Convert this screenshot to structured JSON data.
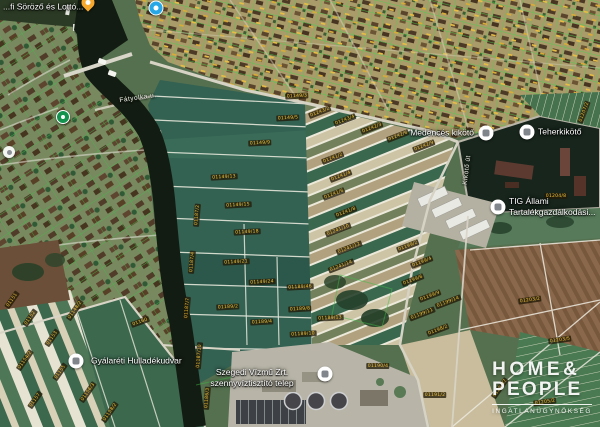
{
  "app": {
    "type": "satellite-map-with-cadastral-overlay",
    "region": "Szeged / Gyálarét, Tisza riverside"
  },
  "watermark": {
    "line1": "HOME&",
    "line2": "PEOPLE",
    "tagline": "INGATLANÜGYNÖKSÉG"
  },
  "colors": {
    "cadastral_green": "#43bd4b",
    "parcel_label_text": "#f0c23c",
    "field_green": "#336152",
    "river_water": "#131c12",
    "harbor_water": "#17251c",
    "poi_white": "#ffffff",
    "pin_orange": "#f7a92d",
    "marker_blue": "#28a7e6",
    "marker_green": "#13934e"
  },
  "pois": [
    {
      "id": "sorozo-lotto",
      "kind": "pin-orange",
      "x": 88,
      "y": 7,
      "label": "...fi Söröző és Lottó...",
      "label_x": 3,
      "label_y": 7,
      "align": "left"
    },
    {
      "id": "blue-place",
      "kind": "circle-blue",
      "x": 156,
      "y": 8
    },
    {
      "id": "park-place",
      "kind": "circle-green",
      "x": 63,
      "y": 117
    },
    {
      "id": "small-white-place",
      "kind": "circle-white-small",
      "x": 9,
      "y": 152
    },
    {
      "id": "gyalareti-hulladekudvar",
      "kind": "circle-white",
      "x": 76,
      "y": 361,
      "label": "Gyálaréti Hulladékudvar",
      "label_x": 91,
      "label_y": 361,
      "align": "left"
    },
    {
      "id": "szegedi-vizmu",
      "kind": "circle-white",
      "x": 325,
      "y": 374,
      "lines": [
        "Szegedi Vízmű Zrt.",
        "szennyvíztisztító telep"
      ],
      "label_x": 252,
      "label_y": 378,
      "align": "center"
    },
    {
      "id": "tig-allami",
      "kind": "circle-white",
      "x": 498,
      "y": 207,
      "lines": [
        "TIG Állami",
        "Tartalékgazdálkodási..."
      ],
      "label_x": 509,
      "label_y": 207,
      "align": "left"
    },
    {
      "id": "medences-kikoto",
      "kind": "circle-white",
      "x": 486,
      "y": 133,
      "label": "Medencés kikötő",
      "label_x": 474,
      "label_y": 133,
      "align": "right"
    },
    {
      "id": "teherkikoto",
      "kind": "circle-white",
      "x": 527,
      "y": 132,
      "label": "Teherkikötő",
      "label_x": 538,
      "label_y": 132,
      "align": "left"
    }
  ],
  "street_labels": [
    {
      "text": "Fátyolka u.",
      "x": 138,
      "y": 98,
      "rot": -8
    },
    {
      "text": "Kikötő út",
      "x": 467,
      "y": 170,
      "rot": -83
    }
  ],
  "parcel_labels": [
    {
      "t": "01149/3",
      "x": 297,
      "y": 96,
      "r": -3
    },
    {
      "t": "01149/5",
      "x": 288,
      "y": 118,
      "r": -3
    },
    {
      "t": "01149/9",
      "x": 260,
      "y": 143,
      "r": -3
    },
    {
      "t": "01149/13",
      "x": 224,
      "y": 177,
      "r": -3
    },
    {
      "t": "01149/15",
      "x": 238,
      "y": 205,
      "r": -3
    },
    {
      "t": "01149/18",
      "x": 247,
      "y": 232,
      "r": -3
    },
    {
      "t": "01149/21",
      "x": 236,
      "y": 262,
      "r": -3
    },
    {
      "t": "01149/24",
      "x": 262,
      "y": 282,
      "r": -3
    },
    {
      "t": "01189/2",
      "x": 228,
      "y": 307,
      "r": -3
    },
    {
      "t": "01189/4",
      "x": 262,
      "y": 322,
      "r": -3
    },
    {
      "t": "01189/8",
      "x": 300,
      "y": 309,
      "r": -3
    },
    {
      "t": "01189/10",
      "x": 303,
      "y": 334,
      "r": -3
    },
    {
      "t": "01189/13",
      "x": 330,
      "y": 318,
      "r": -3
    },
    {
      "t": "01189/46",
      "x": 300,
      "y": 287,
      "r": -3
    },
    {
      "t": "01187/2",
      "x": 197,
      "y": 215,
      "r": -85
    },
    {
      "t": "01187/4",
      "x": 192,
      "y": 262,
      "r": -85
    },
    {
      "t": "01187/7",
      "x": 187,
      "y": 308,
      "r": -85
    },
    {
      "t": "01187/10",
      "x": 199,
      "y": 356,
      "r": -85
    },
    {
      "t": "01186/3",
      "x": 207,
      "y": 398,
      "r": -85
    },
    {
      "t": "01243/2",
      "x": 320,
      "y": 112,
      "r": -21
    },
    {
      "t": "01243/4",
      "x": 345,
      "y": 120,
      "r": -21
    },
    {
      "t": "01242/3",
      "x": 372,
      "y": 128,
      "r": -21
    },
    {
      "t": "01242/6",
      "x": 398,
      "y": 136,
      "r": -21
    },
    {
      "t": "01242/9",
      "x": 424,
      "y": 146,
      "r": -21
    },
    {
      "t": "01241/2",
      "x": 333,
      "y": 158,
      "r": -21
    },
    {
      "t": "01241/4",
      "x": 341,
      "y": 176,
      "r": -21
    },
    {
      "t": "01241/6",
      "x": 334,
      "y": 194,
      "r": -21
    },
    {
      "t": "01241/8",
      "x": 346,
      "y": 212,
      "r": -21
    },
    {
      "t": "01241/10",
      "x": 338,
      "y": 230,
      "r": -21
    },
    {
      "t": "01241/12",
      "x": 349,
      "y": 248,
      "r": -21
    },
    {
      "t": "01241/14",
      "x": 341,
      "y": 266,
      "r": -21
    },
    {
      "t": "01199/2",
      "x": 408,
      "y": 246,
      "r": -21
    },
    {
      "t": "01199/4",
      "x": 422,
      "y": 262,
      "r": -21
    },
    {
      "t": "01199/6",
      "x": 413,
      "y": 280,
      "r": -21
    },
    {
      "t": "01199/9",
      "x": 430,
      "y": 296,
      "r": -21
    },
    {
      "t": "01199/11",
      "x": 422,
      "y": 314,
      "r": -21
    },
    {
      "t": "01199/14",
      "x": 448,
      "y": 302,
      "r": -21
    },
    {
      "t": "01198/2",
      "x": 438,
      "y": 330,
      "r": -21
    },
    {
      "t": "01204/8",
      "x": 556,
      "y": 196,
      "r": 0
    },
    {
      "t": "01207/2",
      "x": 584,
      "y": 112,
      "r": -70
    },
    {
      "t": "01152",
      "x": 30,
      "y": 318,
      "r": -55
    },
    {
      "t": "01153",
      "x": 52,
      "y": 338,
      "r": -55
    },
    {
      "t": "01154/2",
      "x": 25,
      "y": 360,
      "r": -55
    },
    {
      "t": "01155",
      "x": 60,
      "y": 372,
      "r": -55
    },
    {
      "t": "01156/3",
      "x": 88,
      "y": 392,
      "r": -55
    },
    {
      "t": "01157",
      "x": 35,
      "y": 400,
      "r": -55
    },
    {
      "t": "01158/2",
      "x": 110,
      "y": 412,
      "r": -55
    },
    {
      "t": "01148/2",
      "x": 75,
      "y": 310,
      "r": -55
    },
    {
      "t": "01151",
      "x": 12,
      "y": 300,
      "r": -55
    },
    {
      "t": "01160",
      "x": 140,
      "y": 322,
      "r": -20
    },
    {
      "t": "01203/2",
      "x": 530,
      "y": 300,
      "r": -8
    },
    {
      "t": "01203/5",
      "x": 560,
      "y": 340,
      "r": -8
    },
    {
      "t": "01202/7",
      "x": 500,
      "y": 388,
      "r": -55
    },
    {
      "t": "01205/2",
      "x": 545,
      "y": 402,
      "r": -8
    },
    {
      "t": "01191/2",
      "x": 435,
      "y": 395,
      "r": 0
    },
    {
      "t": "01190/4",
      "x": 378,
      "y": 366,
      "r": 0
    }
  ]
}
